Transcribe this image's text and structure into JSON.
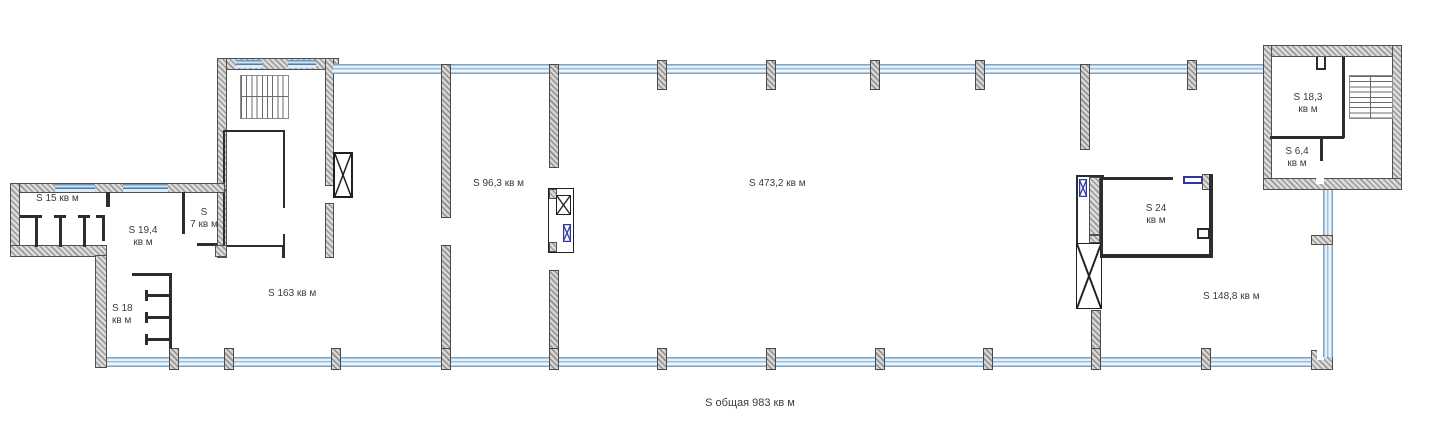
{
  "title": "floor-plan",
  "colors": {
    "wall_hatch": "#9a9a9a",
    "wall_edge": "#4f4f4f",
    "glazing_blue": "#7ba3c4",
    "accent_blue": "#2b36a0",
    "text": "#3b3b3b"
  },
  "rooms": {
    "r15": {
      "l1": "S 15 кв м"
    },
    "r19": {
      "l1": "S 19,4",
      "l2": "кв м"
    },
    "r7": {
      "l1": "S",
      "l2": "7 кв м"
    },
    "r18": {
      "l1": "S 18",
      "l2": "кв м"
    },
    "r163": {
      "l1": "S 163 кв м"
    },
    "r96": {
      "l1": "S 96,3 кв м"
    },
    "r473": {
      "l1": "S 473,2 кв м"
    },
    "r24": {
      "l1": "S 24",
      "l2": "кв м"
    },
    "r148": {
      "l1": "S 148,8 кв м"
    },
    "r183": {
      "l1": "S 18,3",
      "l2": "кв м"
    },
    "r64": {
      "l1": "S 6,4",
      "l2": "кв м"
    }
  },
  "footer": {
    "total_label": "S общая 983 кв м"
  }
}
